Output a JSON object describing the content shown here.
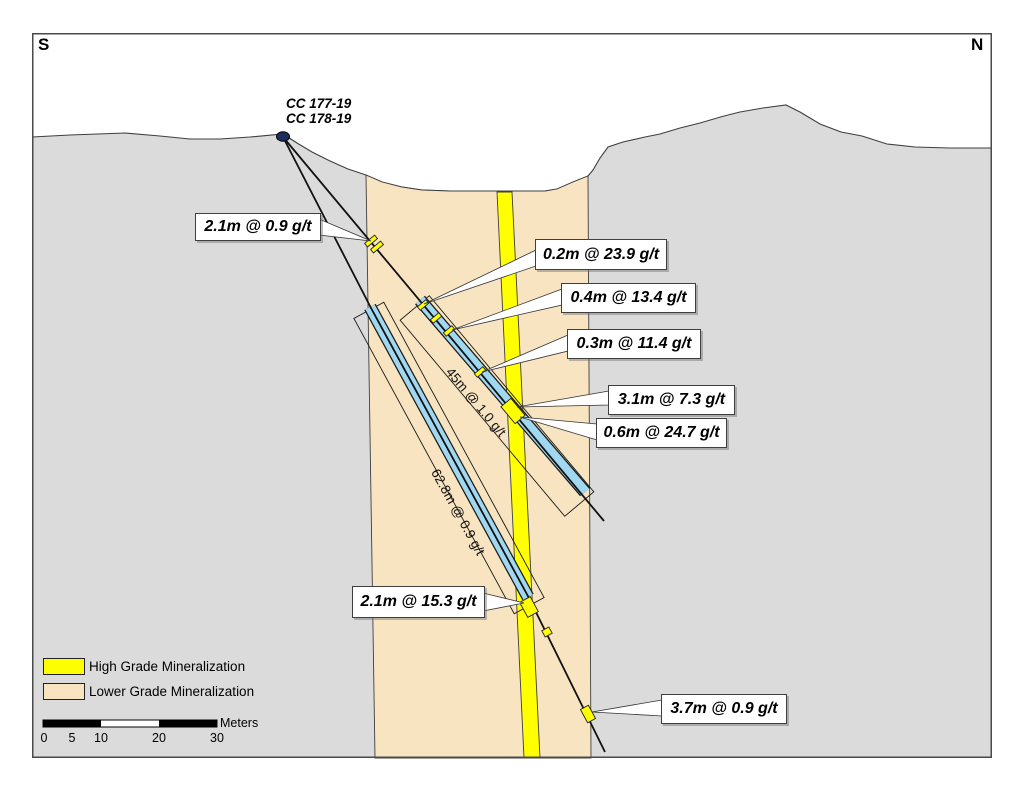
{
  "figure": {
    "title": "Drill section cross-section",
    "orientation_left": "S",
    "orientation_right": "N"
  },
  "collar": {
    "labels": [
      "CC 177-19",
      "CC 178-19"
    ]
  },
  "callouts": [
    {
      "text": "2.1m @ 0.9 g/t"
    },
    {
      "text": "0.2m @ 23.9 g/t"
    },
    {
      "text": "0.4m @ 13.4 g/t"
    },
    {
      "text": "0.3m @ 11.4 g/t"
    },
    {
      "text": "3.1m @ 7.3 g/t"
    },
    {
      "text": "0.6m @ 24.7 g/t"
    },
    {
      "text": "2.1m @ 15.3 g/t"
    },
    {
      "text": "3.7m @ 0.9 g/t"
    }
  ],
  "interval_labels": [
    {
      "text": "45m @ 1.0 g/t"
    },
    {
      "text": "62.8m @ 0.9 g/t"
    }
  ],
  "legend": {
    "items": [
      {
        "label": "High Grade Mineralization",
        "color": "#FFFF00"
      },
      {
        "label": "Lower Grade Mineralization",
        "color": "#F8E4C0"
      }
    ]
  },
  "scalebar": {
    "ticks": [
      "0",
      "5",
      "10",
      "20",
      "30"
    ],
    "unit": "Meters"
  },
  "colors": {
    "terrain": "#DBDBDB",
    "high_grade": "#FFFF00",
    "lower_grade": "#F8E4C0",
    "interval_highlight": "#9FD8F0",
    "collar_dot": "#1C2E5E"
  }
}
